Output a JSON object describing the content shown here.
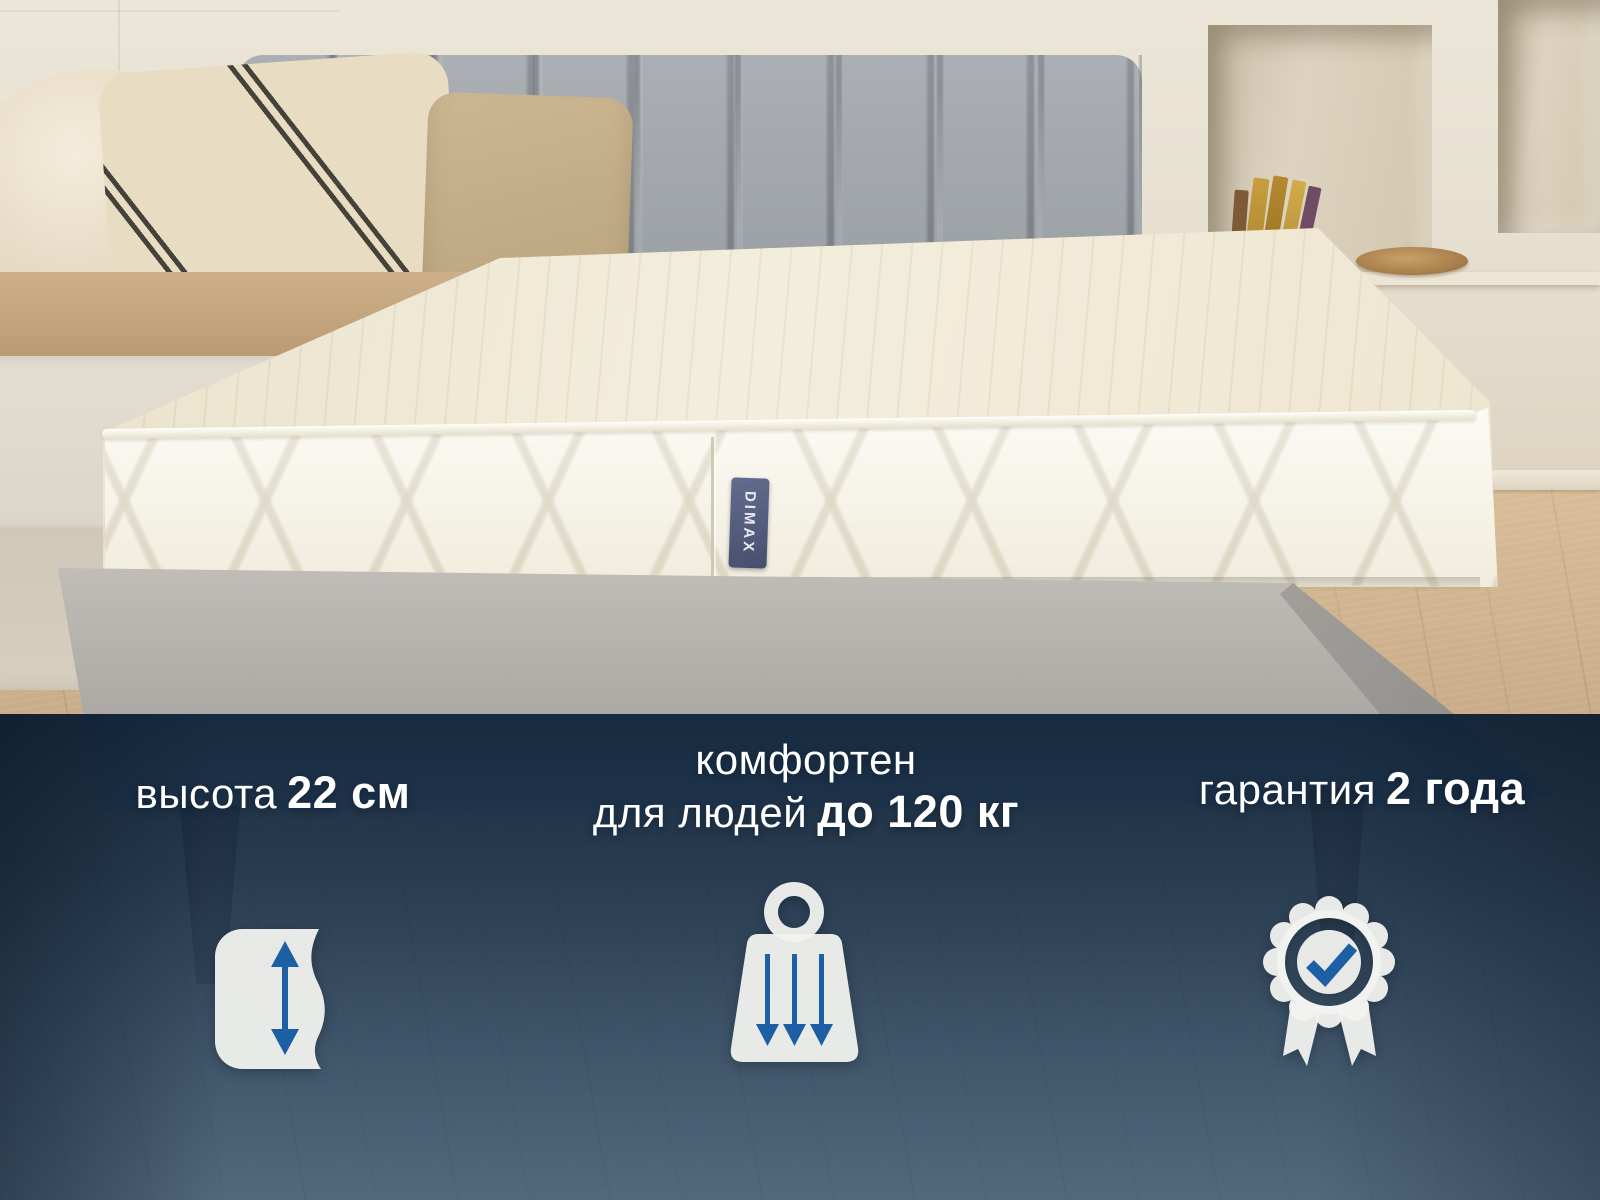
{
  "image": {
    "type": "product promo photo",
    "subject": "white quilted mattress on grey upholstered bed in beige bedroom"
  },
  "brand_tag": {
    "text": "DIMAX"
  },
  "overlay": {
    "features": [
      {
        "id": "height",
        "label": "высота",
        "value": "22 см",
        "icon": "mattress-height-arrow-icon"
      },
      {
        "id": "weight-capacity",
        "line1": "комфортен",
        "line2_label": "для людей",
        "line2_value": "до 120 кг",
        "icon": "weight-pressure-icon"
      },
      {
        "id": "warranty",
        "label": "гарантия",
        "value": "2 года",
        "icon": "quality-ribbon-badge-icon"
      }
    ]
  },
  "colors": {
    "accent_blue": "#1d5fa5",
    "overlay_navy_top": "#16334f",
    "overlay_steel_blue_bottom": "#3a6286",
    "icon_white": "#f2f3f0",
    "text_white": "#ffffff",
    "wall_cream": "#e7e0d1",
    "headboard_grey": "#9ba0a5",
    "mattress_white": "#f9f6eb",
    "frame_grey": "#aeaba7",
    "floor_wood": "#c8ab85",
    "tag_navy": "#4d5678"
  }
}
